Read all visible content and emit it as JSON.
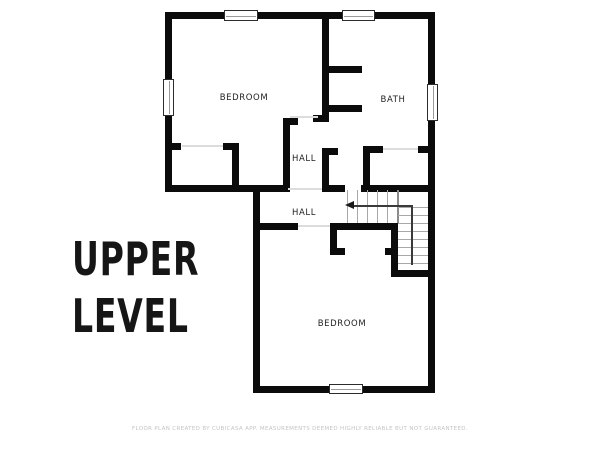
{
  "title": {
    "line1": "UPPER",
    "line2": "LEVEL"
  },
  "footer": {
    "text": "FLOOR PLAN CREATED BY CUBICASA APP. MEASUREMENTS DEEMED HIGHLY RELIABLE BUT NOT GUARANTEED."
  },
  "colors": {
    "wall": "#0b0b0b",
    "label": "#222222",
    "stair": "#a8a8a8",
    "opening": "#dcdcdc",
    "footer": "#c4c4c4",
    "background": "#ffffff"
  },
  "rooms": [
    {
      "id": "bedroom-upper",
      "label": "BEDROOM",
      "x": 244,
      "y": 98
    },
    {
      "id": "bath",
      "label": "BATH",
      "x": 393,
      "y": 100
    },
    {
      "id": "hall-upper",
      "label": "HALL",
      "x": 304,
      "y": 159
    },
    {
      "id": "hall-lower",
      "label": "HALL",
      "x": 304,
      "y": 213
    },
    {
      "id": "bedroom-lower",
      "label": "BEDROOM",
      "x": 342,
      "y": 324
    }
  ],
  "plan": {
    "walls": [
      [
        165,
        12,
        270,
        7
      ],
      [
        165,
        12,
        7,
        180
      ],
      [
        428,
        12,
        7,
        381
      ],
      [
        165,
        185,
        123,
        7
      ],
      [
        322,
        185,
        23,
        7
      ],
      [
        361,
        185,
        74,
        7
      ],
      [
        322,
        12,
        7,
        110
      ],
      [
        313,
        115,
        11,
        7
      ],
      [
        329,
        66,
        33,
        7
      ],
      [
        329,
        105,
        33,
        7
      ],
      [
        283,
        118,
        7,
        74
      ],
      [
        283,
        118,
        15,
        7
      ],
      [
        322,
        148,
        7,
        44
      ],
      [
        329,
        148,
        9,
        7
      ],
      [
        165,
        143,
        16,
        7
      ],
      [
        223,
        143,
        16,
        7
      ],
      [
        232,
        150,
        7,
        42
      ],
      [
        363,
        146,
        20,
        7
      ],
      [
        418,
        146,
        17,
        7
      ],
      [
        363,
        153,
        7,
        39
      ],
      [
        253,
        185,
        7,
        208
      ],
      [
        253,
        386,
        182,
        7
      ],
      [
        260,
        223,
        38,
        7
      ],
      [
        330,
        223,
        68,
        7
      ],
      [
        330,
        230,
        7,
        25
      ],
      [
        330,
        248,
        15,
        7
      ],
      [
        385,
        248,
        13,
        7
      ],
      [
        391,
        223,
        7,
        54
      ],
      [
        391,
        270,
        44,
        7
      ]
    ],
    "openings": [
      [
        290,
        116,
        28,
        2
      ],
      [
        182,
        145,
        41,
        2
      ],
      [
        383,
        148,
        35,
        2
      ],
      [
        288,
        188,
        34,
        2
      ],
      [
        298,
        225,
        32,
        2
      ]
    ],
    "windows": [
      [
        224,
        10,
        34,
        11,
        "h"
      ],
      [
        342,
        10,
        33,
        11,
        "h"
      ],
      [
        163,
        79,
        11,
        37,
        "v"
      ],
      [
        427,
        84,
        11,
        37,
        "v"
      ],
      [
        329,
        384,
        34,
        10,
        "h"
      ]
    ],
    "stair_treads_vertical": {
      "xs": [
        347,
        357,
        367,
        377,
        387
      ],
      "y": 190,
      "h": 33,
      "w": 1.3
    },
    "stair_boundary": [
      397,
      190,
      1.8,
      33
    ],
    "stair_treads_horizontal": {
      "ys": [
        207,
        215,
        223,
        231,
        239,
        247,
        255,
        263
      ],
      "x": 398,
      "w": 30,
      "h": 1.3
    },
    "arrow": {
      "shaft_h": [
        353,
        205,
        59,
        1.5
      ],
      "shaft_v": [
        411,
        205,
        1.5,
        60
      ],
      "head_x": 345,
      "head_y": 201
    }
  }
}
